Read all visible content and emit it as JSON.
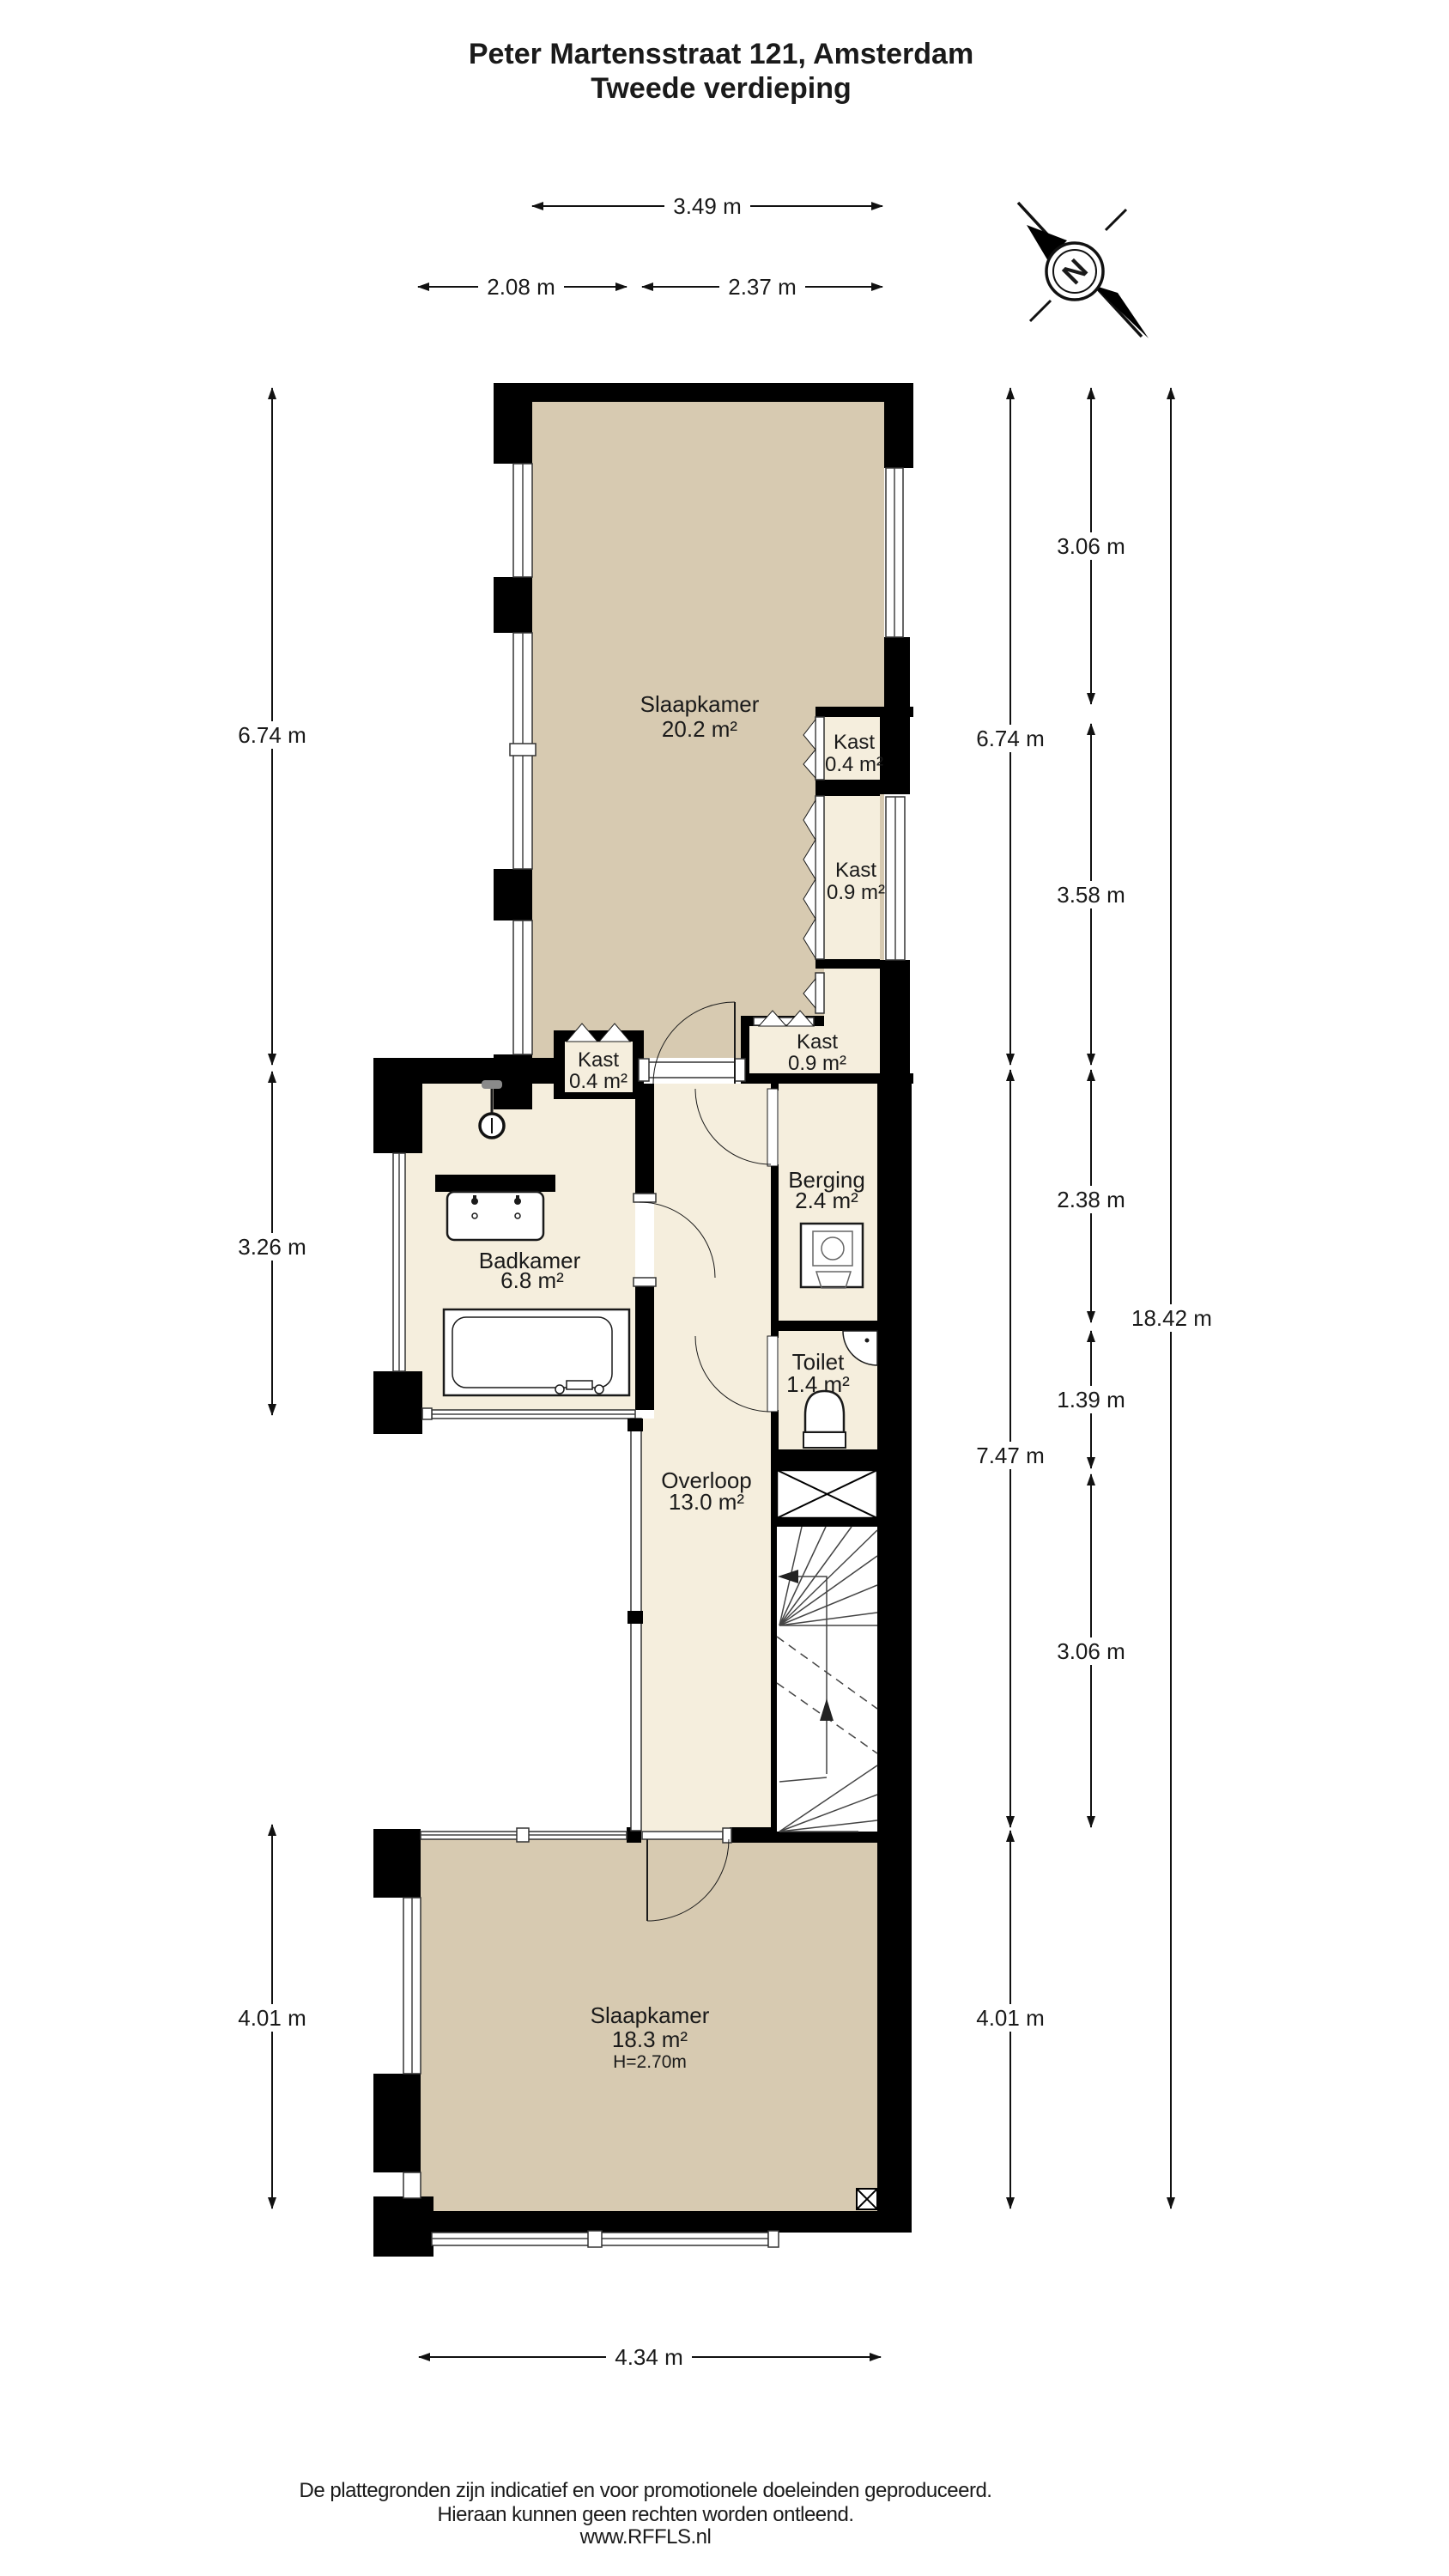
{
  "title": {
    "line1": "Peter Martensstraat 121, Amsterdam",
    "line2": "Tweede verdieping"
  },
  "compass": {
    "letter": "N"
  },
  "rooms": {
    "slaapkamer_boven": {
      "name": "Slaapkamer",
      "area": "20.2 m²"
    },
    "kast_boven_1": {
      "name": "Kast",
      "area": "0.4 m²"
    },
    "kast_boven_2": {
      "name": "Kast",
      "area": "0.9 m²"
    },
    "kast_onder": {
      "name": "Kast",
      "area": "0.9 m²"
    },
    "kast_links": {
      "name": "Kast",
      "area": "0.4 m²"
    },
    "badkamer": {
      "name": "Badkamer",
      "area": "6.8 m²"
    },
    "berging": {
      "name": "Berging",
      "area": "2.4 m²"
    },
    "toilet": {
      "name": "Toilet",
      "area": "1.4 m²"
    },
    "overloop": {
      "name": "Overloop",
      "area": "13.0 m²"
    },
    "slaapkamer_beneden": {
      "name": "Slaapkamer",
      "area": "18.3 m²",
      "ceiling_height": "H=2.70m"
    }
  },
  "dimensions": {
    "top": [
      {
        "label": "3.49 m"
      },
      {
        "label": "2.08 m"
      },
      {
        "label": "2.37 m"
      }
    ],
    "left": [
      {
        "label": "6.74 m"
      },
      {
        "label": "3.26 m"
      },
      {
        "label": "4.01 m"
      }
    ],
    "right_col1": [
      {
        "label": "6.74 m"
      },
      {
        "label": "7.47 m"
      },
      {
        "label": "4.01 m"
      }
    ],
    "right_col2": [
      {
        "label": "3.06 m"
      },
      {
        "label": "3.58 m"
      },
      {
        "label": "2.38 m"
      },
      {
        "label": "1.39 m"
      },
      {
        "label": "3.06 m"
      }
    ],
    "right_col3": [
      {
        "label": "18.42 m"
      }
    ],
    "bottom": [
      {
        "label": "4.34 m"
      }
    ]
  },
  "footer": {
    "line1": "De plattegronden zijn indicatief en voor promotionele doeleinden geproduceerd.",
    "line2": "Hieraan kunnen geen rechten worden ontleend.",
    "line3": "www.RFFLS.nl"
  },
  "colors": {
    "wall": "#000000",
    "bedroom_floor": "#d7cab1",
    "closet_floor": "#f5eedd",
    "background": "#ffffff",
    "line": "#1a1a1a"
  }
}
